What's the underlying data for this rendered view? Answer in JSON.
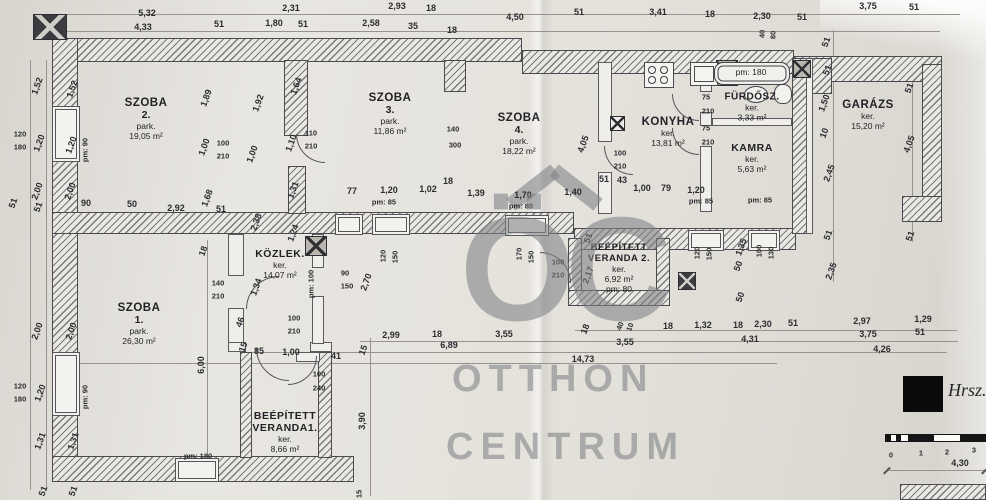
{
  "watermark": {
    "logo": "ÖC",
    "line1": "OTTHON",
    "line2": "CENTRUM"
  },
  "annotation": {
    "hrsz_label": "Hrsz.",
    "scale_dim_label": "4,30"
  },
  "colors": {
    "paper": "#e5e2dc",
    "line": "#4a4a4f",
    "watermark": "#82868a",
    "redaction": "#0b0b0b"
  },
  "rooms": {
    "szoba2": {
      "name": "SZOBA",
      "num": "2.",
      "type": "park.",
      "area": "19,05 m²"
    },
    "szoba3": {
      "name": "SZOBA",
      "num": "3.",
      "type": "park.",
      "area": "11,86 m²"
    },
    "szoba4": {
      "name": "SZOBA",
      "num": "4.",
      "type": "park.",
      "area": "18,22 m²"
    },
    "konyha": {
      "name": "KONYHA",
      "type": "ker.",
      "area": "13,81 m²"
    },
    "furdosz": {
      "name": "FÜRDŐSZ.",
      "type": "ker.",
      "area": "3,33 m²",
      "pm": "pm: 180"
    },
    "kamra": {
      "name": "KAMRA",
      "type": "ker.",
      "area": "5,63 m²"
    },
    "garazs": {
      "name": "GARÁZS",
      "type": "ker.",
      "area": "15,20 m²"
    },
    "szoba1": {
      "name": "SZOBA",
      "num": "1.",
      "type": "park.",
      "area": "26,30 m²"
    },
    "kozlek": {
      "name": "KÖZLEK.",
      "type": "ker.",
      "area": "14,07 m²"
    },
    "veranda2": {
      "name": "BEÉPÍTETT",
      "num": "VERANDA 2.",
      "type": "ker.",
      "area": "6,92 m²",
      "pm": "pm: 80"
    },
    "veranda1": {
      "name": "BEÉPÍTETT",
      "num": "VERANDA1.",
      "type": "ker.",
      "area": "8,66 m²"
    }
  },
  "dimension_labels": [
    {
      "t": "5,32",
      "x": 147,
      "y": 13
    },
    {
      "t": "2,31",
      "x": 291,
      "y": 8
    },
    {
      "t": "2,93",
      "x": 397,
      "y": 6
    },
    {
      "t": "18",
      "x": 431,
      "y": 8
    },
    {
      "t": "4,50",
      "x": 515,
      "y": 17
    },
    {
      "t": "51",
      "x": 579,
      "y": 12
    },
    {
      "t": "3,41",
      "x": 658,
      "y": 12
    },
    {
      "t": "18",
      "x": 710,
      "y": 14
    },
    {
      "t": "2,30",
      "x": 762,
      "y": 16
    },
    {
      "t": "51",
      "x": 802,
      "y": 17
    },
    {
      "t": "3,75",
      "x": 868,
      "y": 6
    },
    {
      "t": "51",
      "x": 914,
      "y": 7
    },
    {
      "t": "4,33",
      "x": 143,
      "y": 27
    },
    {
      "t": "51",
      "x": 219,
      "y": 24
    },
    {
      "t": "1,80",
      "x": 274,
      "y": 23
    },
    {
      "t": "51",
      "x": 303,
      "y": 24
    },
    {
      "t": "2,58",
      "x": 371,
      "y": 23
    },
    {
      "t": "35",
      "x": 413,
      "y": 26
    },
    {
      "t": "18",
      "x": 452,
      "y": 30
    },
    {
      "t": "40",
      "x": 762,
      "y": 34,
      "r": -90,
      "s": "sm"
    },
    {
      "t": "80",
      "x": 773,
      "y": 35,
      "r": -90,
      "s": "sm"
    },
    {
      "t": "51",
      "x": 826,
      "y": 42,
      "r": -70
    },
    {
      "t": "1,52",
      "x": 37,
      "y": 86,
      "r": -70
    },
    {
      "t": "1,52",
      "x": 72,
      "y": 89,
      "r": -70
    },
    {
      "t": "120",
      "x": 20,
      "y": 134,
      "s": "sm"
    },
    {
      "t": "180",
      "x": 20,
      "y": 147,
      "s": "sm"
    },
    {
      "t": "1,20",
      "x": 39,
      "y": 143,
      "r": -70
    },
    {
      "t": "1,20",
      "x": 71,
      "y": 145,
      "r": -70
    },
    {
      "t": "pm: 90",
      "x": 85,
      "y": 150,
      "r": -90,
      "s": "sm"
    },
    {
      "t": "2,00",
      "x": 37,
      "y": 191,
      "r": -70
    },
    {
      "t": "2,00",
      "x": 70,
      "y": 191,
      "r": -70
    },
    {
      "t": "51",
      "x": 13,
      "y": 203,
      "r": -70
    },
    {
      "t": "51",
      "x": 38,
      "y": 207,
      "r": -70
    },
    {
      "t": "90",
      "x": 86,
      "y": 203
    },
    {
      "t": "50",
      "x": 132,
      "y": 204
    },
    {
      "t": "2,92",
      "x": 176,
      "y": 208
    },
    {
      "t": "2,00",
      "x": 37,
      "y": 331,
      "r": -70
    },
    {
      "t": "2,00",
      "x": 71,
      "y": 331,
      "r": -70
    },
    {
      "t": "120",
      "x": 20,
      "y": 386,
      "s": "sm"
    },
    {
      "t": "180",
      "x": 20,
      "y": 399,
      "s": "sm"
    },
    {
      "t": "1,20",
      "x": 40,
      "y": 393,
      "r": -70
    },
    {
      "t": "pm: 90",
      "x": 85,
      "y": 397,
      "r": -90,
      "s": "sm"
    },
    {
      "t": "1,31",
      "x": 40,
      "y": 441,
      "r": -70
    },
    {
      "t": "1,31",
      "x": 73,
      "y": 441,
      "r": -70
    },
    {
      "t": "51",
      "x": 43,
      "y": 491,
      "r": -70
    },
    {
      "t": "51",
      "x": 73,
      "y": 491,
      "r": -70
    },
    {
      "t": "1,89",
      "x": 206,
      "y": 98,
      "r": -70
    },
    {
      "t": "1,92",
      "x": 258,
      "y": 103,
      "r": -70
    },
    {
      "t": "1,64",
      "x": 296,
      "y": 86,
      "r": -70
    },
    {
      "t": "1,10",
      "x": 291,
      "y": 143,
      "r": -70
    },
    {
      "t": "110",
      "x": 311,
      "y": 133,
      "s": "sm"
    },
    {
      "t": "210",
      "x": 311,
      "y": 146,
      "s": "sm"
    },
    {
      "t": "1,00",
      "x": 204,
      "y": 147,
      "r": -70
    },
    {
      "t": "100",
      "x": 223,
      "y": 143,
      "s": "sm"
    },
    {
      "t": "210",
      "x": 223,
      "y": 156,
      "s": "sm"
    },
    {
      "t": "1,00",
      "x": 252,
      "y": 154,
      "r": -70
    },
    {
      "t": "1,68",
      "x": 207,
      "y": 198,
      "r": -70
    },
    {
      "t": "51",
      "x": 221,
      "y": 209
    },
    {
      "t": "1,31",
      "x": 293,
      "y": 190,
      "r": -70
    },
    {
      "t": "2,38",
      "x": 256,
      "y": 222,
      "r": -70
    },
    {
      "t": "1,24",
      "x": 293,
      "y": 233,
      "r": -70
    },
    {
      "t": "18",
      "x": 203,
      "y": 251,
      "r": -70
    },
    {
      "t": "140",
      "x": 453,
      "y": 129,
      "s": "sm"
    },
    {
      "t": "300",
      "x": 455,
      "y": 145,
      "s": "sm"
    },
    {
      "t": "4,05",
      "x": 583,
      "y": 144,
      "r": -70
    },
    {
      "t": "77",
      "x": 352,
      "y": 191
    },
    {
      "t": "1,20",
      "x": 389,
      "y": 190
    },
    {
      "t": "pm: 85",
      "x": 384,
      "y": 202,
      "s": "sm"
    },
    {
      "t": "1,02",
      "x": 428,
      "y": 189
    },
    {
      "t": "18",
      "x": 448,
      "y": 181
    },
    {
      "t": "1,39",
      "x": 476,
      "y": 193
    },
    {
      "t": "1,70",
      "x": 523,
      "y": 195
    },
    {
      "t": "pm: 80",
      "x": 521,
      "y": 206,
      "s": "sm"
    },
    {
      "t": "1,40",
      "x": 573,
      "y": 192
    },
    {
      "t": "51",
      "x": 604,
      "y": 179
    },
    {
      "t": "43",
      "x": 622,
      "y": 180
    },
    {
      "t": "1,00",
      "x": 642,
      "y": 188
    },
    {
      "t": "79",
      "x": 666,
      "y": 188
    },
    {
      "t": "1,20",
      "x": 696,
      "y": 190
    },
    {
      "t": "pm: 85",
      "x": 701,
      "y": 201,
      "s": "sm"
    },
    {
      "t": "pm: 85",
      "x": 760,
      "y": 200,
      "s": "sm"
    },
    {
      "t": "100",
      "x": 620,
      "y": 153,
      "s": "sm"
    },
    {
      "t": "210",
      "x": 620,
      "y": 166,
      "s": "sm"
    },
    {
      "t": "75",
      "x": 706,
      "y": 97,
      "s": "sm"
    },
    {
      "t": "210",
      "x": 708,
      "y": 111,
      "s": "sm"
    },
    {
      "t": "75",
      "x": 706,
      "y": 128,
      "s": "sm"
    },
    {
      "t": "210",
      "x": 708,
      "y": 142,
      "s": "sm"
    },
    {
      "t": "90",
      "x": 345,
      "y": 273,
      "s": "sm"
    },
    {
      "t": "150",
      "x": 347,
      "y": 286,
      "s": "sm"
    },
    {
      "t": "2,70",
      "x": 366,
      "y": 282,
      "r": -70
    },
    {
      "t": "120",
      "x": 383,
      "y": 256,
      "r": -90,
      "s": "sm"
    },
    {
      "t": "150",
      "x": 395,
      "y": 257,
      "r": -90,
      "s": "sm"
    },
    {
      "t": "170",
      "x": 519,
      "y": 254,
      "r": -90,
      "s": "sm"
    },
    {
      "t": "150",
      "x": 531,
      "y": 257,
      "r": -90,
      "s": "sm"
    },
    {
      "t": "120",
      "x": 697,
      "y": 253,
      "r": -90,
      "s": "sm"
    },
    {
      "t": "150",
      "x": 709,
      "y": 254,
      "r": -90,
      "s": "sm"
    },
    {
      "t": "1,35",
      "x": 741,
      "y": 247,
      "r": -70
    },
    {
      "t": "50",
      "x": 738,
      "y": 266,
      "r": -70
    },
    {
      "t": "100",
      "x": 759,
      "y": 251,
      "r": -90,
      "s": "sm"
    },
    {
      "t": "130",
      "x": 771,
      "y": 253,
      "r": -90,
      "s": "sm"
    },
    {
      "t": "50",
      "x": 740,
      "y": 297,
      "r": -70
    },
    {
      "t": "pm: 100",
      "x": 311,
      "y": 284,
      "r": -90,
      "s": "sm"
    },
    {
      "t": "1,34",
      "x": 256,
      "y": 287,
      "r": -70
    },
    {
      "t": "140",
      "x": 218,
      "y": 283,
      "s": "sm"
    },
    {
      "t": "210",
      "x": 218,
      "y": 296,
      "s": "sm"
    },
    {
      "t": "46",
      "x": 240,
      "y": 322,
      "r": -70
    },
    {
      "t": "100",
      "x": 294,
      "y": 318,
      "s": "sm"
    },
    {
      "t": "210",
      "x": 294,
      "y": 331,
      "s": "sm"
    },
    {
      "t": "15",
      "x": 243,
      "y": 347,
      "r": -70
    },
    {
      "t": "85",
      "x": 259,
      "y": 351
    },
    {
      "t": "1,00",
      "x": 291,
      "y": 352
    },
    {
      "t": "41",
      "x": 336,
      "y": 356
    },
    {
      "t": "15",
      "x": 363,
      "y": 350,
      "r": -70
    },
    {
      "t": "100",
      "x": 319,
      "y": 374,
      "s": "sm"
    },
    {
      "t": "240",
      "x": 319,
      "y": 388,
      "s": "sm"
    },
    {
      "t": "6,00",
      "x": 201,
      "y": 365,
      "r": -90
    },
    {
      "t": "pm: 180",
      "x": 198,
      "y": 456,
      "s": "sm"
    },
    {
      "t": "3,90",
      "x": 362,
      "y": 421,
      "r": -90
    },
    {
      "t": "15",
      "x": 359,
      "y": 494,
      "r": -90,
      "s": "sm"
    },
    {
      "t": "51",
      "x": 588,
      "y": 238,
      "r": -70
    },
    {
      "t": "2,17",
      "x": 588,
      "y": 275,
      "r": -70
    },
    {
      "t": "100",
      "x": 558,
      "y": 262,
      "s": "sm"
    },
    {
      "t": "210",
      "x": 558,
      "y": 275,
      "s": "sm"
    },
    {
      "t": "2,99",
      "x": 391,
      "y": 335
    },
    {
      "t": "18",
      "x": 437,
      "y": 334
    },
    {
      "t": "3,55",
      "x": 504,
      "y": 334
    },
    {
      "t": "6,89",
      "x": 449,
      "y": 345
    },
    {
      "t": "18",
      "x": 585,
      "y": 329,
      "r": -70
    },
    {
      "t": "40",
      "x": 620,
      "y": 326,
      "r": -70,
      "s": "sm"
    },
    {
      "t": "10",
      "x": 630,
      "y": 327,
      "r": -70,
      "s": "sm"
    },
    {
      "t": "18",
      "x": 668,
      "y": 326
    },
    {
      "t": "1,32",
      "x": 703,
      "y": 325
    },
    {
      "t": "18",
      "x": 738,
      "y": 325
    },
    {
      "t": "2,30",
      "x": 763,
      "y": 324
    },
    {
      "t": "51",
      "x": 793,
      "y": 323
    },
    {
      "t": "2,97",
      "x": 862,
      "y": 321
    },
    {
      "t": "1,29",
      "x": 923,
      "y": 319
    },
    {
      "t": "3,55",
      "x": 625,
      "y": 342
    },
    {
      "t": "4,31",
      "x": 750,
      "y": 339
    },
    {
      "t": "3,75",
      "x": 868,
      "y": 334
    },
    {
      "t": "51",
      "x": 920,
      "y": 332
    },
    {
      "t": "4,26",
      "x": 882,
      "y": 349
    },
    {
      "t": "14,73",
      "x": 583,
      "y": 359
    },
    {
      "t": "51",
      "x": 827,
      "y": 70,
      "r": -70
    },
    {
      "t": "1,50",
      "x": 824,
      "y": 103,
      "r": -70
    },
    {
      "t": "10",
      "x": 824,
      "y": 133,
      "r": -70
    },
    {
      "t": "2,45",
      "x": 829,
      "y": 173,
      "r": -70
    },
    {
      "t": "51",
      "x": 828,
      "y": 235,
      "r": -70
    },
    {
      "t": "2,35",
      "x": 831,
      "y": 271,
      "r": -70
    },
    {
      "t": "51",
      "x": 909,
      "y": 88,
      "r": -70
    },
    {
      "t": "4,05",
      "x": 909,
      "y": 144,
      "r": -70
    },
    {
      "t": "51",
      "x": 910,
      "y": 236,
      "r": -70
    },
    {
      "t": "0",
      "x": 891,
      "y": 455,
      "s": "sm"
    },
    {
      "t": "1",
      "x": 921,
      "y": 453,
      "s": "sm"
    },
    {
      "t": "2",
      "x": 947,
      "y": 452,
      "s": "sm"
    },
    {
      "t": "3",
      "x": 974,
      "y": 450,
      "s": "sm"
    },
    {
      "t": "4,30",
      "x": 960,
      "y": 463
    }
  ]
}
